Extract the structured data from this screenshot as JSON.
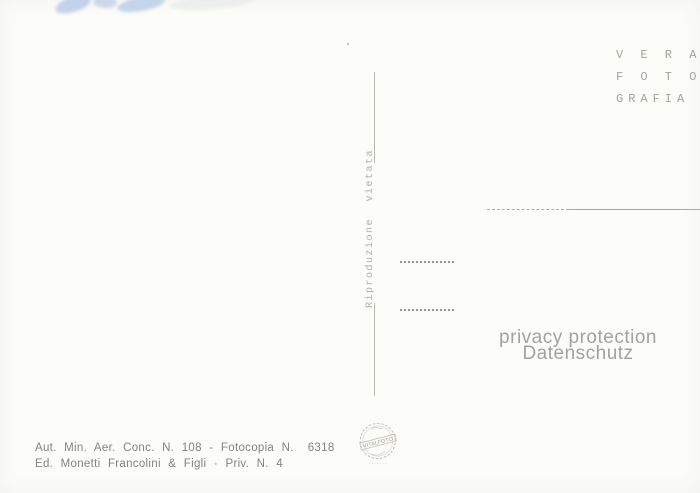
{
  "postcard": {
    "publisher_mark": [
      "V E R A",
      "F O T O",
      "GRAFIA"
    ],
    "reproduction_notice": "Riproduzione vietata",
    "privacy_watermark": {
      "line1": "privacy protection",
      "line2": "Datenschutz"
    },
    "stamp": {
      "text": "VITALFOTO",
      "subtext": "·······"
    },
    "credits": {
      "line1_label": "Aut. Min. Aer. Conc. N. 108 - Fotocopia N.",
      "line1_number": "6318",
      "line2": "Ed. Monetti Francolini & Figli · Priv. N. 4"
    },
    "colors": {
      "paper": "#fcfcf9",
      "ink_gray": "#85837e",
      "faint_gray": "#b0ada7",
      "watermark_gray": "#a2a2a2",
      "smudge_blue": "#6f99d6"
    }
  }
}
